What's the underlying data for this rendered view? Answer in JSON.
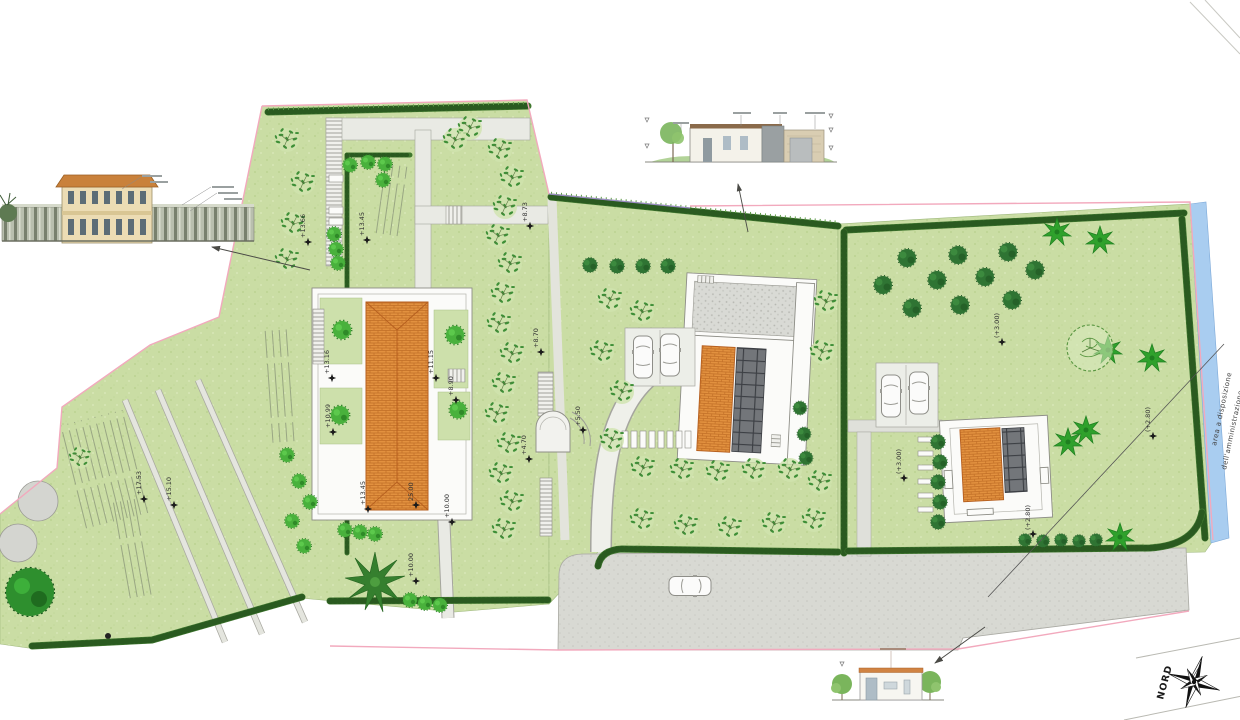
{
  "compass": {
    "north_label": "NORD"
  },
  "area_note": {
    "line1": "area a disposizione",
    "line2": "dell'amministrazione comunale"
  },
  "colors": {
    "lawn": "#cadda4",
    "roof_tiles": "#e2913f",
    "canal": "#a9cdf0",
    "boundary_line": "#f2a9bd",
    "hedge": "#40782f",
    "road": "#d8d9d3"
  },
  "spot_elevations": [
    {
      "x": 308,
      "y": 242,
      "v": "+13.66"
    },
    {
      "x": 367,
      "y": 240,
      "v": "+13.45"
    },
    {
      "x": 332,
      "y": 378,
      "v": "+13.16"
    },
    {
      "x": 436,
      "y": 378,
      "v": "+11.15"
    },
    {
      "x": 456,
      "y": 400,
      "v": "+8.90"
    },
    {
      "x": 333,
      "y": 432,
      "v": "+10.99"
    },
    {
      "x": 530,
      "y": 226,
      "v": "+8.73"
    },
    {
      "x": 541,
      "y": 352,
      "v": "+8.70"
    },
    {
      "x": 583,
      "y": 430,
      "v": "+5.50"
    },
    {
      "x": 529,
      "y": 459,
      "v": "+4.70"
    },
    {
      "x": 144,
      "y": 499,
      "v": "+17.53"
    },
    {
      "x": 174,
      "y": 505,
      "v": "+15.10"
    },
    {
      "x": 368,
      "y": 509,
      "v": "+13.45"
    },
    {
      "x": 416,
      "y": 505,
      "v": "25.00"
    },
    {
      "x": 416,
      "y": 581,
      "v": "+10.00"
    },
    {
      "x": 452,
      "y": 522,
      "v": "+10.00"
    },
    {
      "x": 904,
      "y": 478,
      "v": "(+3.00)"
    },
    {
      "x": 1002,
      "y": 342,
      "v": "(+3.00)"
    },
    {
      "x": 1153,
      "y": 436,
      "v": "(+2.80)"
    },
    {
      "x": 1033,
      "y": 534,
      "v": "(+2.80)"
    }
  ]
}
